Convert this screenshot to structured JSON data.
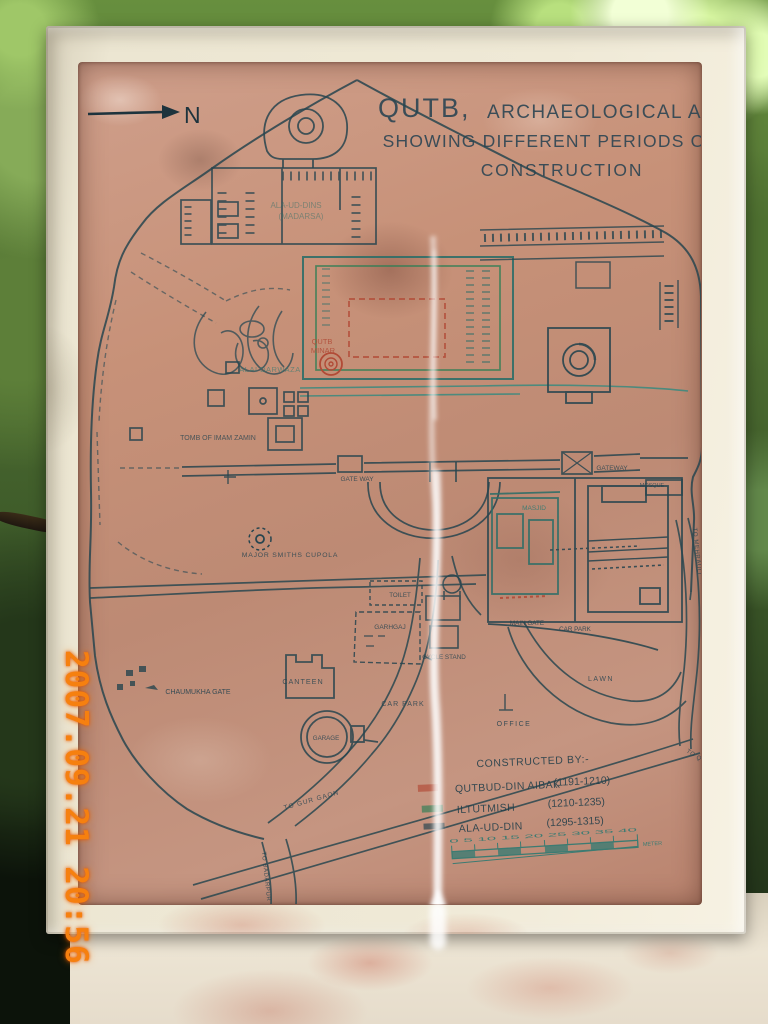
{
  "photo": {
    "timestamp": "2007.09.21 20:56"
  },
  "sign": {
    "title": {
      "word1": "QUTB,",
      "word2": "ARCHAEOLOGICAL AREA",
      "line2": "SHOWING DIFFERENT PERIODS OF",
      "line3": "CONSTRUCTION"
    },
    "north_label": "N",
    "map_labels": {
      "madarsa_line1": "ALA-UD-DINS",
      "madarsa_line2": "(MADARSA)",
      "alai_darwaza": "ALAI DARWAZA",
      "qutb_minar_line1": "QUTB",
      "qutb_minar_line2": "MINAR",
      "tomb_of_imam_zamin": "TOMB OF IMAM ZAMIN",
      "gate_way": "GATE WAY",
      "gateway": "GATEWAY",
      "mosque": "MOSQUE",
      "masjid": "MASJID",
      "major_smiths_cupola": "MAJOR SMITHS CUPOLA",
      "toilet": "TOILET",
      "garhgaj": "GARHGAJ",
      "main_gate": "MAIN GATE",
      "car_park_east": "CAR PARK",
      "cycle_stand": "CYCLE STAND",
      "canteen": "CANTEEN",
      "chaumukha_gate": "CHAUMUKHA GATE",
      "car_park_south": "CAR PARK",
      "garage": "GARAGE",
      "office": "OFFICE",
      "lawn": "LAWN",
      "road_to_gurgaon": "TO GUR GAON",
      "road_to_badarpur": "TO BADARPUR",
      "road_to_mehrauli": "TO MEHRAULI",
      "road_to_qutb_sahib": "TO QUTB SAHIB"
    },
    "legend": {
      "heading": "CONSTRUCTED BY:-",
      "entries": [
        {
          "name": "QUTBUD-DIN AIBAK",
          "period": "(1191-1210)",
          "color": "#b14a36"
        },
        {
          "name": "ILTUTMISH",
          "period": "(1210-1235)",
          "color": "#2e7e55"
        },
        {
          "name": "ALA-UD-DIN",
          "period": "(1295-1315)",
          "color": "#23424e"
        }
      ]
    },
    "scale_bar": {
      "ticks_text": "0 5 10 15 20 25 30 35 40",
      "unit": "METER"
    }
  },
  "colors": {
    "plate": "#c79682",
    "ink": "#24424f",
    "teal": "#2e7a72",
    "red": "#b14a36",
    "green": "#2e7e55",
    "timestamp_orange": "#f6800f"
  }
}
